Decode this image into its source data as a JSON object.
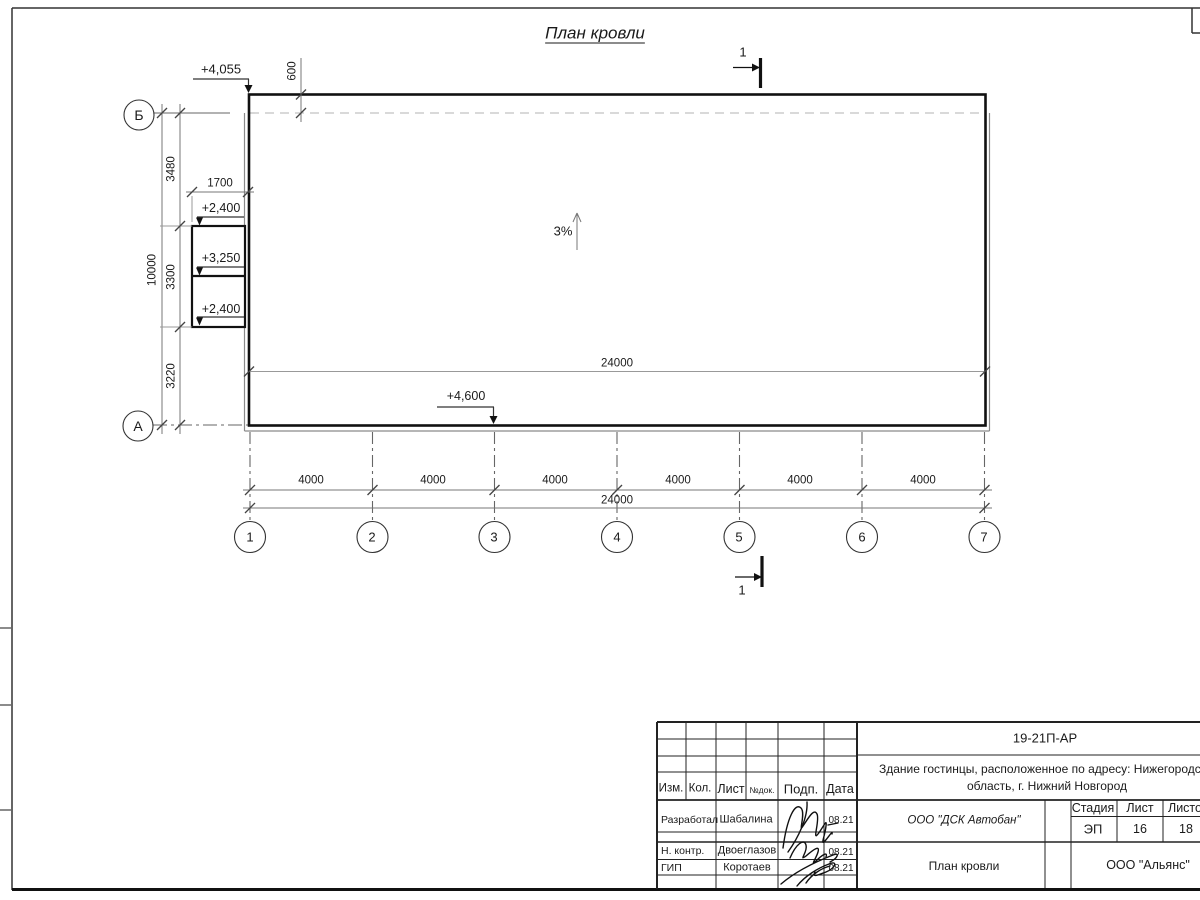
{
  "drawing": {
    "title": "План кровли",
    "section_mark": "1",
    "slope": "3%",
    "elevations": {
      "parapet": "+4,055",
      "canopy_upper": "+2,400",
      "canopy_mid": "+3,250",
      "canopy_lower": "+2,400",
      "entry": "+4,600"
    },
    "dims": {
      "overhang": "600",
      "canopy_width": "1700",
      "left_seg1": "3480",
      "left_seg2": "3300",
      "left_seg3": "3220",
      "left_total": "10000",
      "bays": [
        "4000",
        "4000",
        "4000",
        "4000",
        "4000",
        "4000"
      ],
      "total_inner": "24000",
      "total_bottom": "24000"
    },
    "grid": {
      "cols": [
        "1",
        "2",
        "3",
        "4",
        "5",
        "6",
        "7"
      ],
      "row_a": "А",
      "row_b": "Б"
    }
  },
  "titleblock": {
    "doc_code": "19-21П-АР",
    "project_line1": "Здание гостинцы, расположенное по адресу: Нижегородская",
    "project_line2": "область, г. Нижний Новгород",
    "header": {
      "izm": "Изм.",
      "kol": "Кол.",
      "list": "Лист",
      "ndok": "№док.",
      "podp": "Подп.",
      "data": "Дата"
    },
    "rows": [
      {
        "role": "Разработал",
        "name": "Шабалина",
        "date": "08.21"
      },
      {
        "role": "Н. контр.",
        "name": "Двоеглазов",
        "date": "08.21"
      },
      {
        "role": "ГИП",
        "name": "Коротаев",
        "date": "08.21"
      }
    ],
    "company": "ООО \"ДСК Автобан\"",
    "sheet_title": "План кровли",
    "stage_label": "Стадия",
    "stage_value": "ЭП",
    "sheet_label": "Лист",
    "sheet_value": "16",
    "sheets_label": "Листов",
    "sheets_value": "18",
    "org": "ООО \"Альянс\""
  }
}
